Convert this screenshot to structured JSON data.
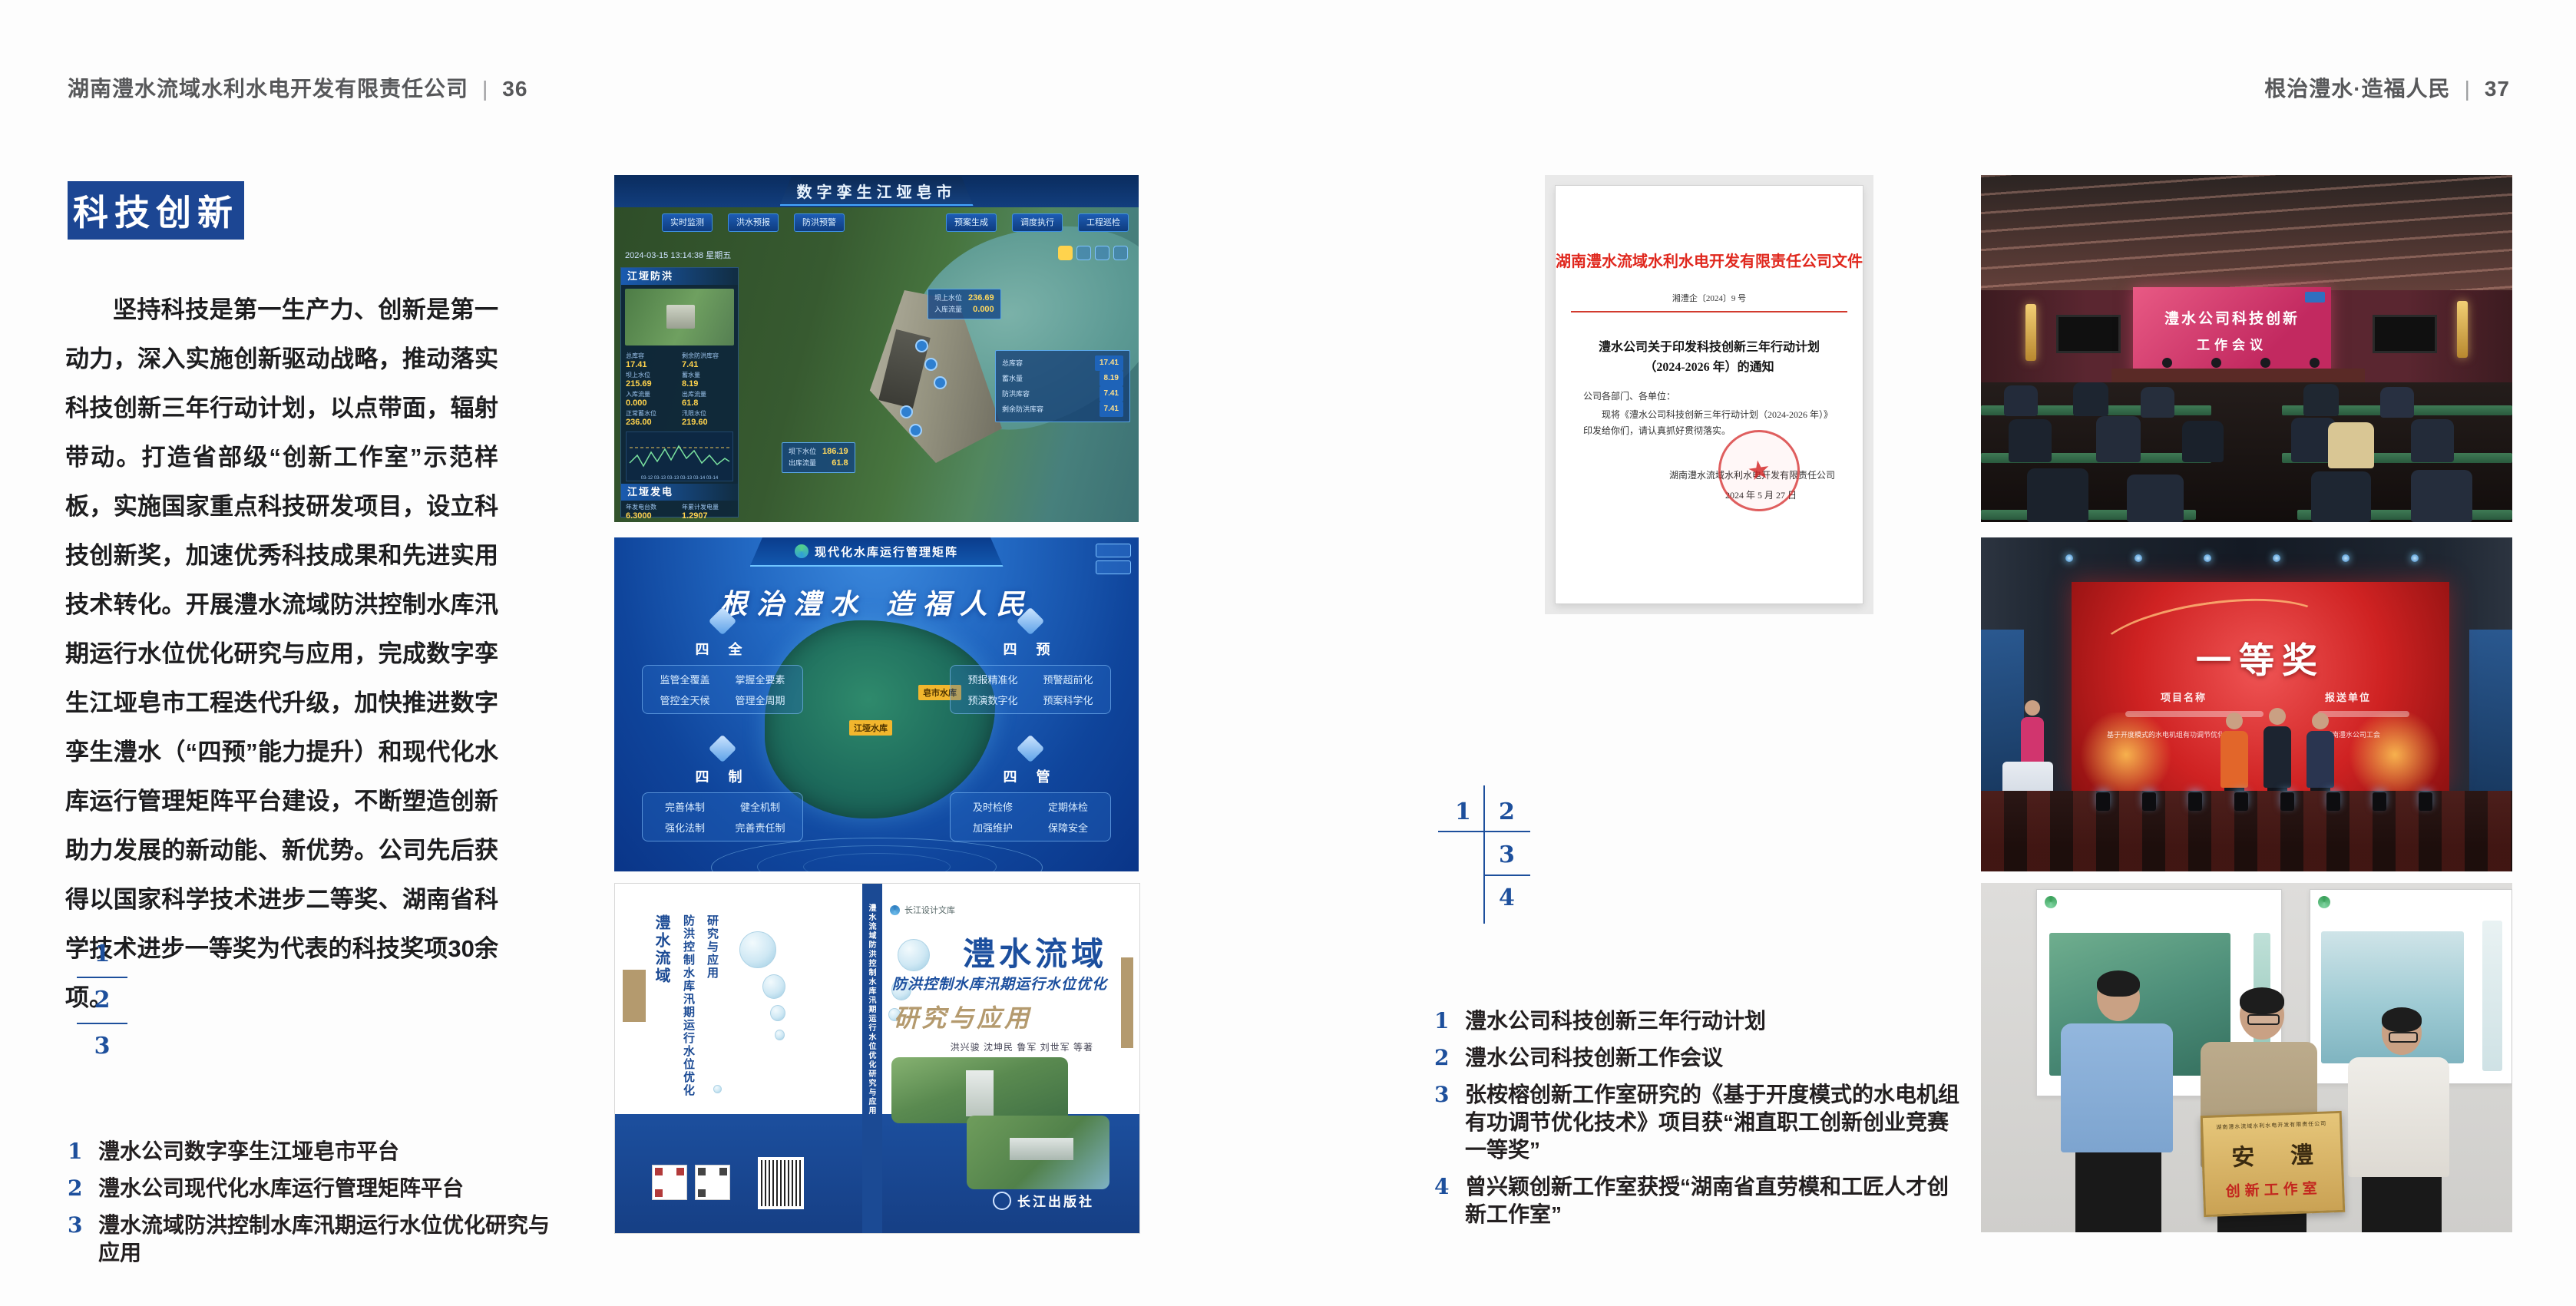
{
  "left_page": {
    "header_title": "湖南澧水流域水利水电开发有限责任公司",
    "header_sep": "|",
    "page_number": "36",
    "badge": "科技创新",
    "paragraph": "坚持科技是第一生产力、创新是第一动力，深入实施创新驱动战略，推动落实科技创新三年行动计划，以点带面，辐射带动。打造省部级“创新工作室”示范样板，实施国家重点科技研发项目，设立科技创新奖，加速优秀科技成果和先进实用技术转化。开展澧水流域防洪控制水库汛期运行水位优化研究与应用，完成数字孪生江垭皂市工程迭代升级，加快推进数字孪生澧水（“四预”能力提升）和现代化水库运行管理矩阵平台建设，不断塑造创新助力发展的新动能、新优势。公司先后获得以国家科学技术进步二等奖、湖南省科学技术进步一等奖为代表的科技奖项30余项。",
    "figure_index": [
      "1",
      "2",
      "3"
    ],
    "captions": [
      {
        "num": "1",
        "text": "澧水公司数字孪生江垭皂市平台"
      },
      {
        "num": "2",
        "text": "澧水公司现代化水库运行管理矩阵平台"
      },
      {
        "num": "3",
        "text": "澧水流域防洪控制水库汛期运行水位优化研究与应用"
      }
    ]
  },
  "right_page": {
    "header_title": "根治澧水·造福人民",
    "header_sep": "|",
    "page_number": "37",
    "figure_index": [
      "1",
      "2",
      "3",
      "4"
    ],
    "captions": [
      {
        "num": "1",
        "text": "澧水公司科技创新三年行动计划"
      },
      {
        "num": "2",
        "text": "澧水公司科技创新工作会议"
      },
      {
        "num": "3",
        "text": "张桉榕创新工作室研究的《基于开度模式的水电机组有功调节优化技术》项目获“湘直职工创新创业竞赛一等奖”"
      },
      {
        "num": "4",
        "text": "曾兴颖创新工作室获授“湖南省直劳模和工匠人才创新工作室”"
      }
    ]
  },
  "dashboard": {
    "title": "数字孪生江垭皂市",
    "timestamp": "2024-03-15 13:14:38 星期五",
    "tabs_left": [
      "实时监测",
      "洪水预报",
      "防洪预警"
    ],
    "tabs_right": [
      "预案生成",
      "调度执行",
      "工程巡检"
    ],
    "panel1_title": "江垭防洪",
    "panel1_rows": [
      {
        "label": "总库容",
        "value": "17.41"
      },
      {
        "label": "剩余防洪库容",
        "value": "7.41"
      },
      {
        "label": "坝上水位",
        "value": "215.69"
      },
      {
        "label": "蓄水量",
        "value": "8.19"
      },
      {
        "label": "入库流量",
        "value": "0.000"
      },
      {
        "label": "出库流量",
        "value": "61.8"
      },
      {
        "label": "正常蓄水位",
        "value": "236.00"
      },
      {
        "label": "汛限水位",
        "value": "219.60"
      }
    ],
    "panel2_title": "江垭发电",
    "panel2_rows": [
      {
        "label": "年发电台数",
        "value": "6.3000"
      },
      {
        "label": "年累计发电量",
        "value": "1.2907"
      },
      {
        "label": "月累计发电量",
        "value": "3359.21"
      },
      {
        "label": "当前出力",
        "value": "0.00"
      },
      {
        "label": "发电流量",
        "value": "0.00"
      },
      {
        "label": "弃水流量",
        "value": "0.00"
      }
    ],
    "callout1": {
      "l1": "坝上水位",
      "v1": "236.69",
      "l2": "入库流量",
      "v2": "0.000"
    },
    "callout2": {
      "l1": "坝下水位",
      "v1": "186.19",
      "l2": "出库流量",
      "v2": "61.8"
    },
    "statbox": [
      {
        "label": "总库容",
        "value": "17.41"
      },
      {
        "label": "蓄水量",
        "value": "8.19"
      },
      {
        "label": "防洪库容",
        "value": "7.41"
      },
      {
        "label": "剩余防洪库容",
        "value": "7.41"
      }
    ],
    "chart_ticks": "03-12  03-13  03-13  03-13  03-14  03-14"
  },
  "matrix": {
    "title": "现代化水库运行管理矩阵",
    "slogan": "根治澧水 造福人民",
    "panels": [
      {
        "title": "四 全",
        "items": [
          "监管全覆盖",
          "掌握全要素",
          "管控全天候",
          "管理全周期"
        ]
      },
      {
        "title": "四 预",
        "items": [
          "预报精准化",
          "预警超前化",
          "预演数字化",
          "预案科学化"
        ]
      },
      {
        "title": "四 制",
        "items": [
          "完善体制",
          "健全机制",
          "强化法制",
          "完善责任制"
        ]
      },
      {
        "title": "四 管",
        "items": [
          "及时检修",
          "定期体检",
          "加强维护",
          "保障安全"
        ]
      }
    ],
    "map_labels": [
      "江垭水库",
      "皂市水库"
    ]
  },
  "book": {
    "series": "长江设计文库",
    "title_main": "澧水流域",
    "title_sub": "防洪控制水库汛期运行水位优化",
    "title_tail": "研究与应用",
    "authors": "洪兴骏 沈坤民 鲁军 刘世军 等著",
    "publisher": "长江出版社",
    "spine_text": "澧水流域防洪控制水库汛期运行水位优化研究与应用",
    "back_title_1": "澧水流域",
    "back_title_2": "防洪控制水库汛期运行水位优化",
    "back_title_3": "研究与应用"
  },
  "document": {
    "header": "湖南澧水流域水利水电开发有限责任公司文件",
    "doc_number": "湘澧企〔2024〕9 号",
    "title_line1": "澧水公司关于印发科技创新三年行动计划",
    "title_line2": "（2024-2026 年）的通知",
    "salutation": "公司各部门、各单位：",
    "body": "现将《澧水公司科技创新三年行动计划（2024-2026 年）》印发给你们，请认真抓好贯彻落实。",
    "signer": "湖南澧水流域水利水电开发有限责任公司",
    "date": "2024 年 5 月 27 日",
    "seal_star": "★"
  },
  "meeting": {
    "screen_line1": "澧水公司科技创新",
    "screen_line2": "工作会议"
  },
  "award": {
    "screen_title": "一等奖",
    "col1_header": "项目名称",
    "col2_header": "报送单位",
    "col1_line2": "基于开度模式的水电机组有功调节优化技术",
    "col2_line2": "湖南澧水公司工会"
  },
  "plaque": {
    "header": "湖南澧水流域水利水电开发有限责任公司",
    "big": "安 澧",
    "sub": "创新工作室"
  }
}
